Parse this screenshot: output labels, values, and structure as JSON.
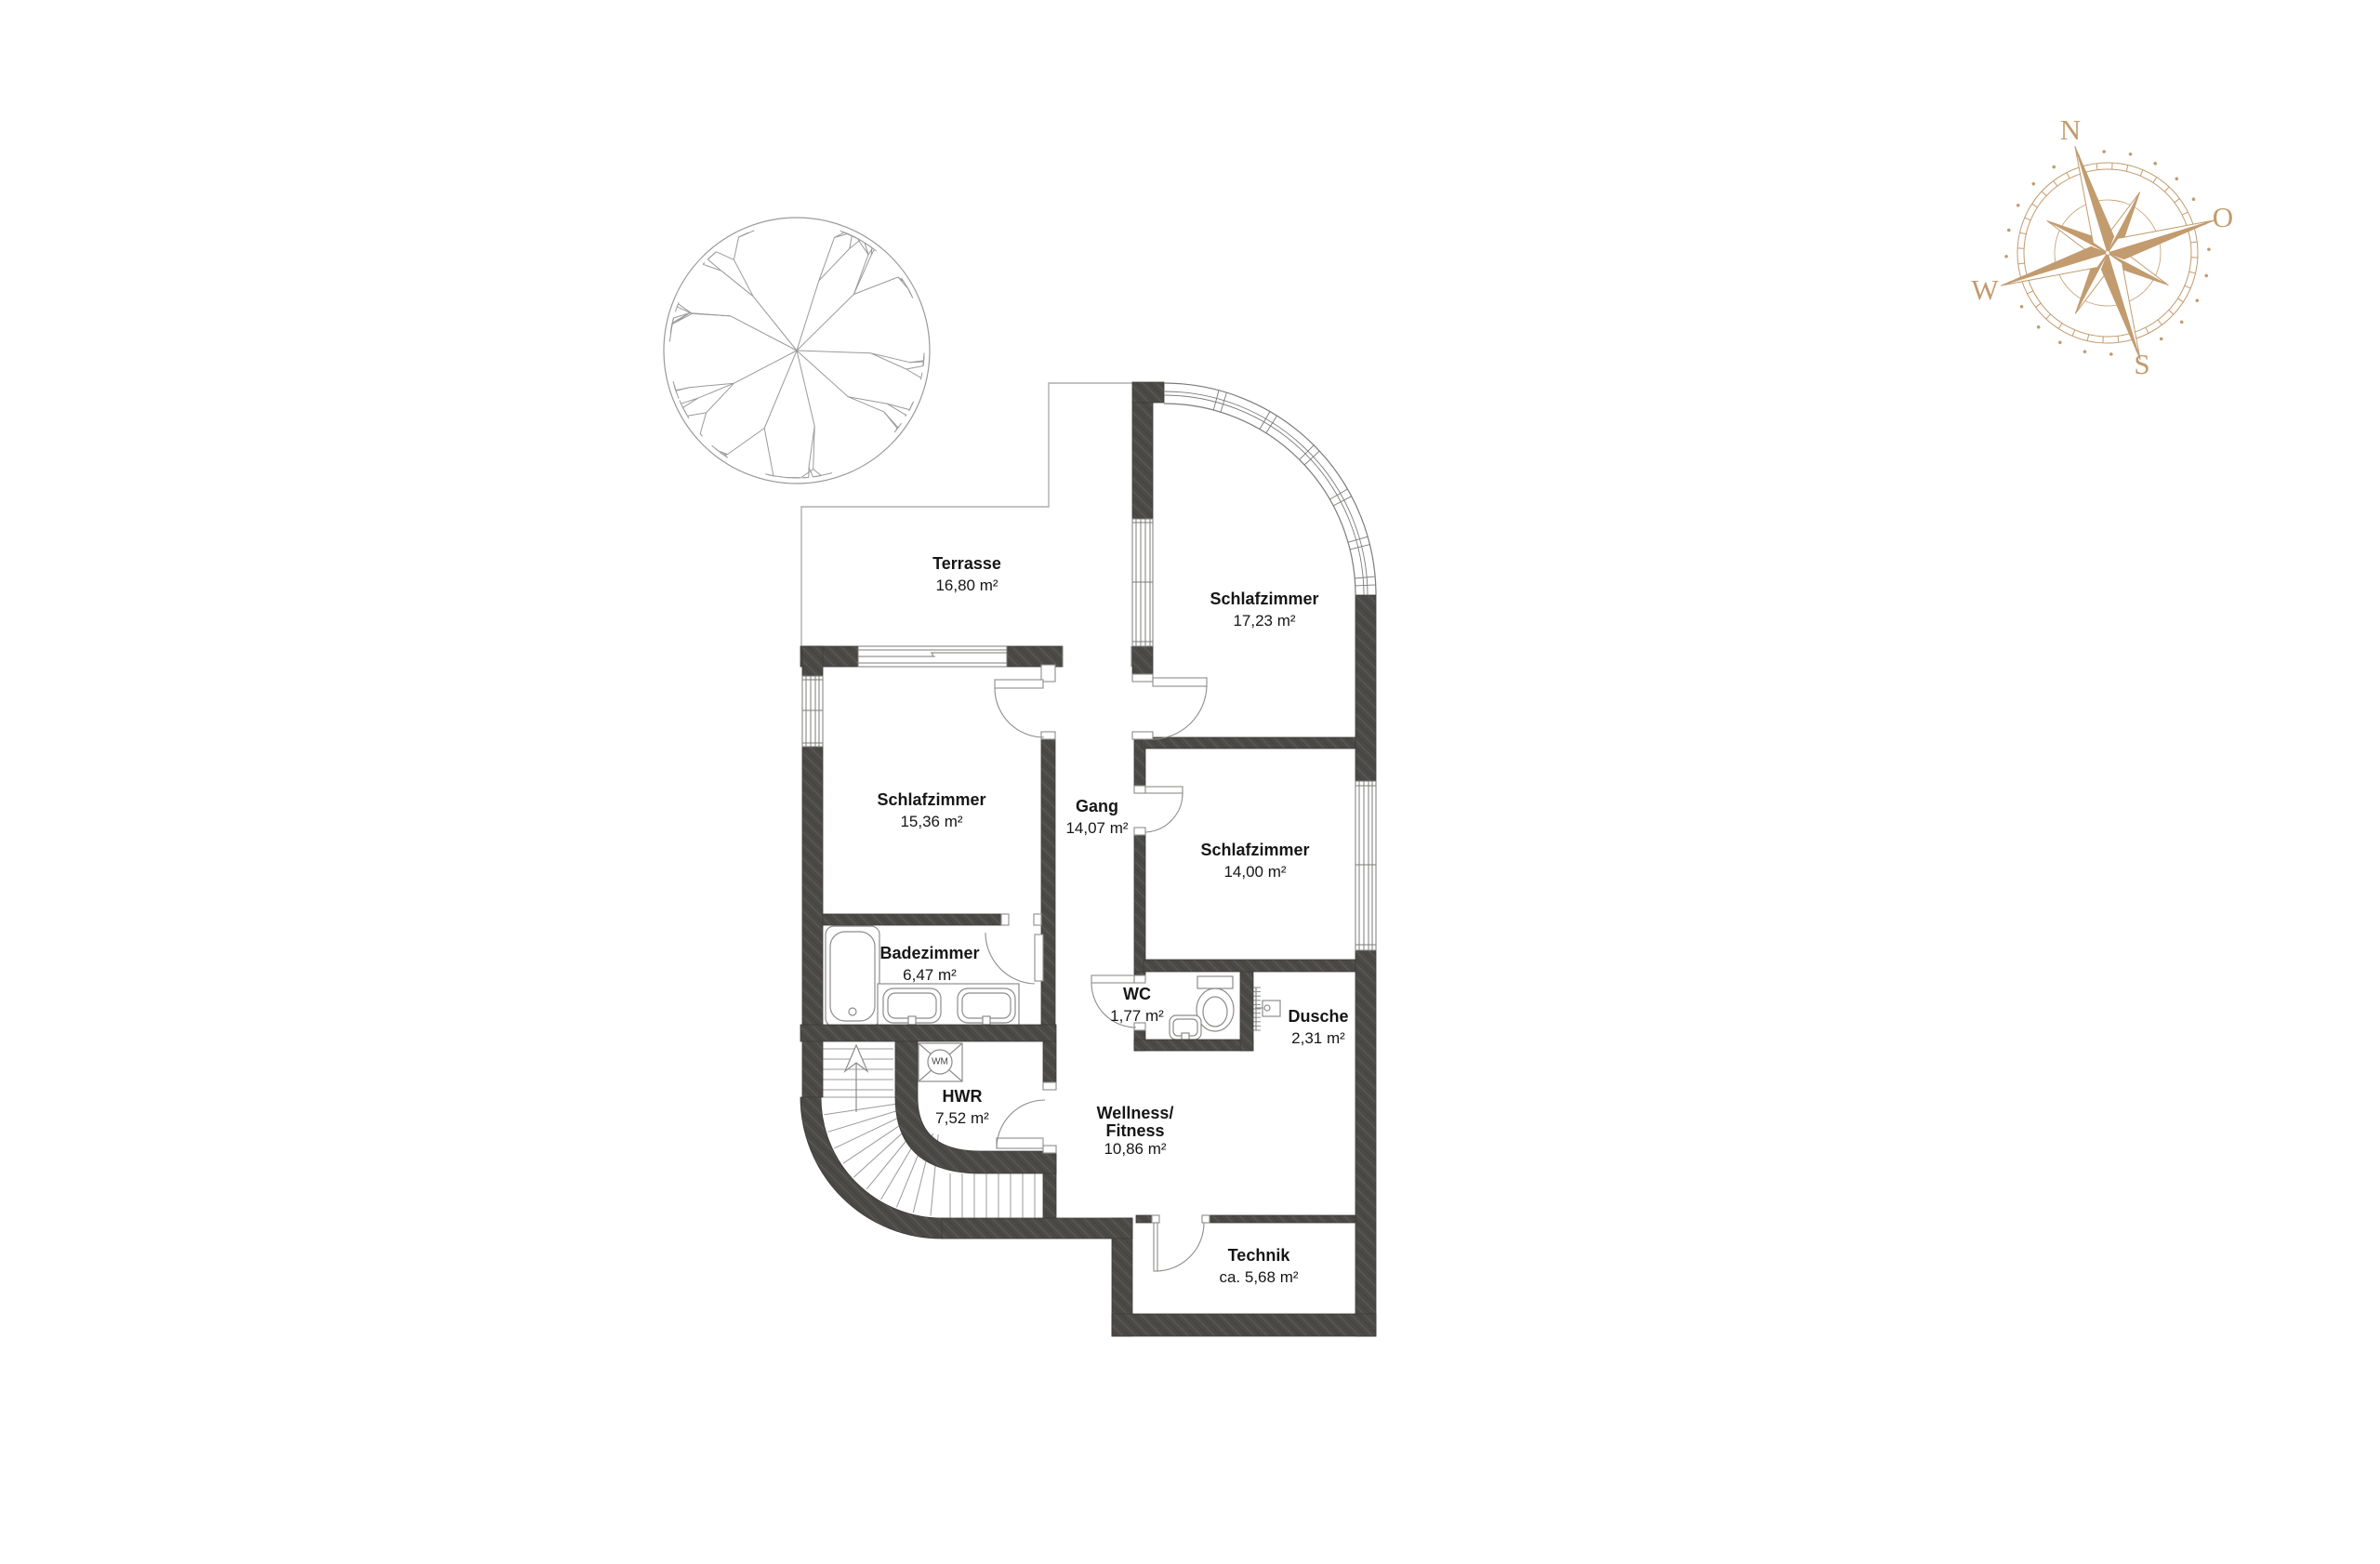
{
  "document": {
    "kind": "floor-plan"
  },
  "rooms": [
    {
      "id": "terrasse",
      "name": "Terrasse",
      "area": "16,80 m²"
    },
    {
      "id": "schlafzimmer-bay",
      "name": "Schlafzimmer",
      "area": "17,23 m²"
    },
    {
      "id": "schlafzimmer-west",
      "name": "Schlafzimmer",
      "area": "15,36 m²"
    },
    {
      "id": "gang",
      "name": "Gang",
      "area": "14,07 m²"
    },
    {
      "id": "schlafzimmer-east",
      "name": "Schlafzimmer",
      "area": "14,00 m²"
    },
    {
      "id": "badezimmer",
      "name": "Badezimmer",
      "area": "6,47 m²"
    },
    {
      "id": "wc",
      "name": "WC",
      "area": "1,77 m²"
    },
    {
      "id": "dusche",
      "name": "Dusche",
      "area": "2,31 m²"
    },
    {
      "id": "hwr",
      "name": "HWR",
      "area": "7,52 m²"
    },
    {
      "id": "wellness",
      "name_line1": "Wellness/",
      "name_line2": "Fitness",
      "area": "10,86 m²"
    },
    {
      "id": "technik",
      "name": "Technik",
      "area": "ca. 5,68 m²"
    }
  ],
  "appliances": {
    "washing_machine": "WM"
  },
  "compass": {
    "labels": {
      "n": "N",
      "o": "O",
      "w": "W",
      "s": "S"
    }
  },
  "colors": {
    "wall": "#4b4a47",
    "wall_grain_light": "#5a5955",
    "wall_grain_dark": "#434240",
    "thin_line": "#8c8c8a",
    "outline": "#adadab",
    "text": "#161616",
    "compass": "#c29b6e"
  }
}
